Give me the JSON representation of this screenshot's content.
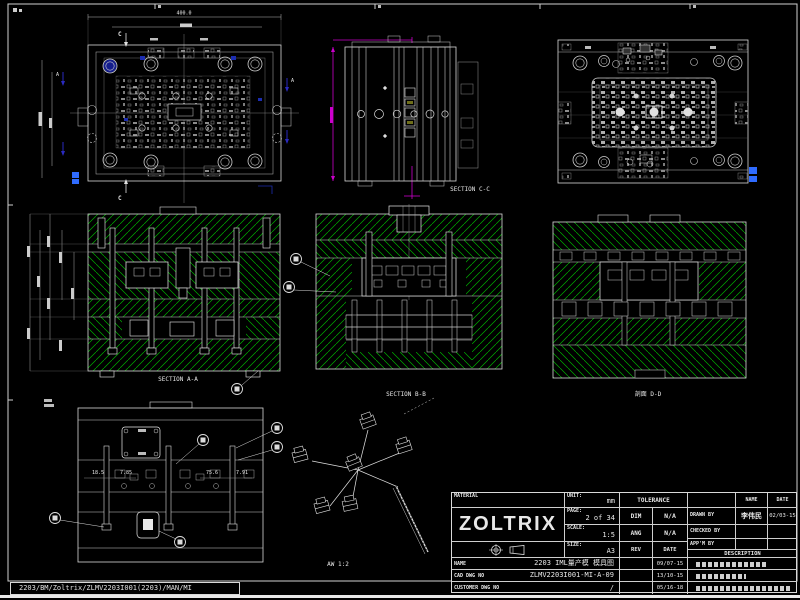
{
  "colors": {
    "background": "#000000",
    "line": "#d9d9d9",
    "hatch_green": "#00ad00",
    "magenta": "#cc00cc",
    "navy_blue": "#1c2db0",
    "bright_blue": "#2f6bff"
  },
  "frame": {
    "path_text": "2203/BM/Zoltrix/ZLMV2203I001(2203)/MAN/MI"
  },
  "labels": {
    "section_aa": "SECTION A-A",
    "section_bb": "SECTION B-B",
    "section_cc": "SECTION C-C",
    "section_dd": "剖面 D-D",
    "detail_scale": "AW 1:2",
    "section_marker_c": "C",
    "section_marker_a": "A",
    "dim_top": "400.0"
  },
  "dims_bottom_view": {
    "d1": "18.5",
    "d2": "7.85",
    "d3": "75.6",
    "d4": "7.91"
  },
  "title_block": {
    "material_label": "MATERIAL",
    "company": "ZOLTRIX",
    "unit_label": "UNIT:",
    "unit_value": "mm",
    "page_label": "PAGE:",
    "page_value": "2 of 34",
    "scale_label": "SCALE:",
    "scale_value": "1:5",
    "size_label": "SIZE:",
    "size_value": "A3",
    "tolerance_label": "TOLERANCE",
    "dim_label": "DIM",
    "dim_value": "N/A",
    "ang_label": "ANG",
    "ang_value": "N/A",
    "rev_label": "REV",
    "rev_date_label": "DATE",
    "name_col_label": "NAME",
    "date_col_label": "DATE",
    "drawn_by_label": "DRAWN BY",
    "drawn_by_name": "李伟民",
    "drawn_by_date": "02/03-15",
    "checked_by_label": "CHECKED BY",
    "approved_by_label": "APP'M BY",
    "description_label": "DESCRIPTION",
    "row_name_label": "NAME",
    "row_name_value": "2203 IML量产模 模具图",
    "row_name_date": "09/07-15",
    "row_dwg_label": "CAD DWG NO",
    "row_dwg_value": "ZLMV2203I001-MI-A-09",
    "row_dwg_date": "13/10-15",
    "row_review_label": "CUSTOMER DWG NO",
    "row_review_value": "/",
    "row_review_date": "05/16-18"
  }
}
